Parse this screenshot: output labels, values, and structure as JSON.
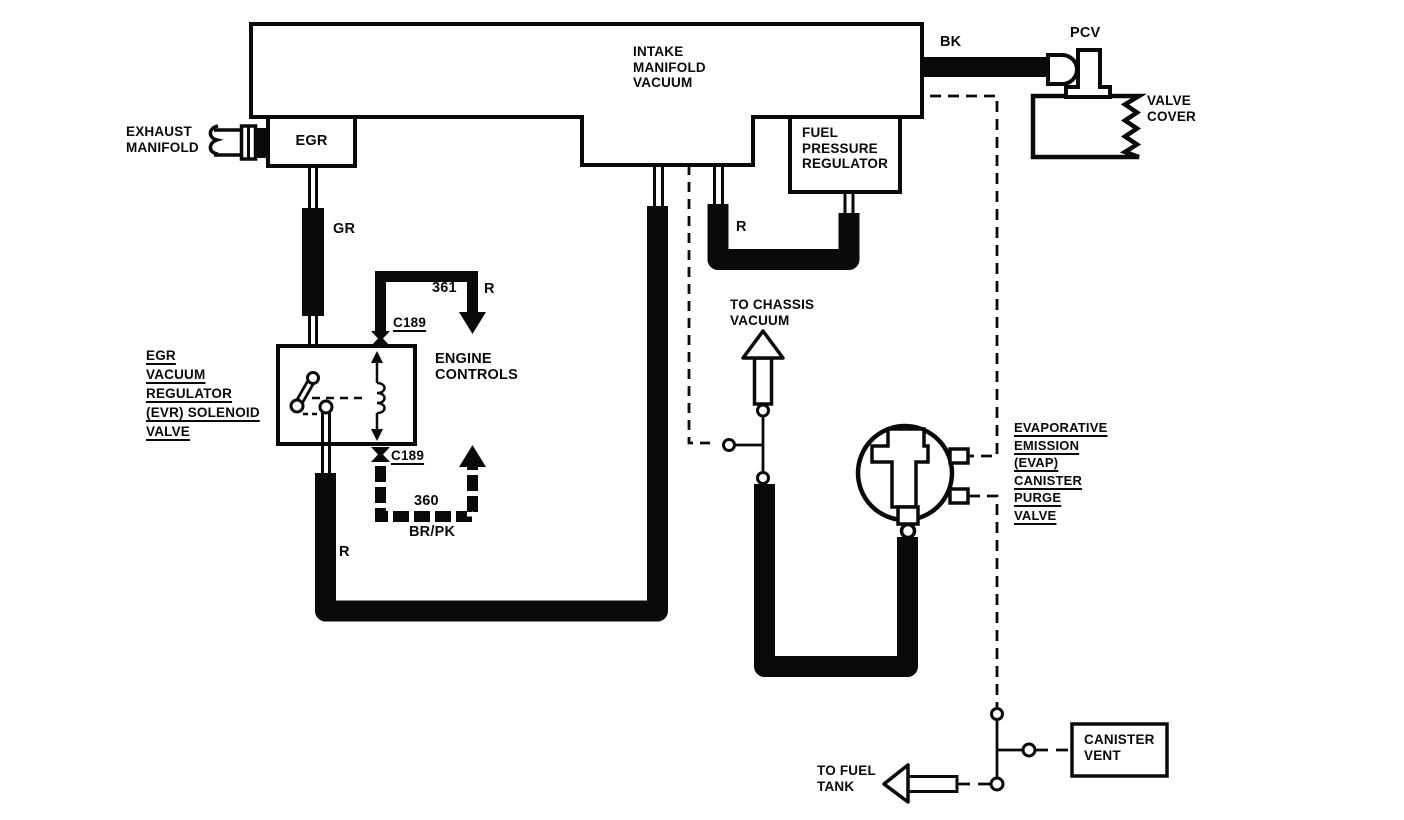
{
  "diagram": {
    "type": "vacuum-hose-routing-diagram",
    "colors": {
      "line": "#0a0a0a",
      "background": "#ffffff"
    }
  },
  "labels": {
    "intake_manifold": "INTAKE\nMANIFOLD\nVACUUM",
    "exhaust_manifold": "EXHAUST\nMANIFOLD",
    "egr": "EGR",
    "gr_hose": "GR",
    "evr_valve": "EGR\nVACUUM\nREGULATOR\n(EVR) SOLENOID\nVALVE",
    "engine_controls": "ENGINE\nCONTROLS",
    "wire_361": "361",
    "wire_361_color": "R",
    "c189_top": "C189",
    "c189_bottom": "C189",
    "wire_360": "360",
    "wire_360_color": "BR/PK",
    "hose_r_evr": "R",
    "hose_r_fpr": "R",
    "fuel_pressure_regulator": "FUEL\nPRESSURE\nREGULATOR",
    "bk_hose": "BK",
    "pcv": "PCV",
    "valve_cover": "VALVE\nCOVER",
    "to_chassis_vacuum": "TO CHASSIS\nVACUUM",
    "evap_purge_valve": "EVAPORATIVE\nEMISSION\n(EVAP)\nCANISTER\nPURGE\nVALVE",
    "canister_vent": "CANISTER\nVENT",
    "to_fuel_tank": "TO FUEL\nTANK"
  }
}
